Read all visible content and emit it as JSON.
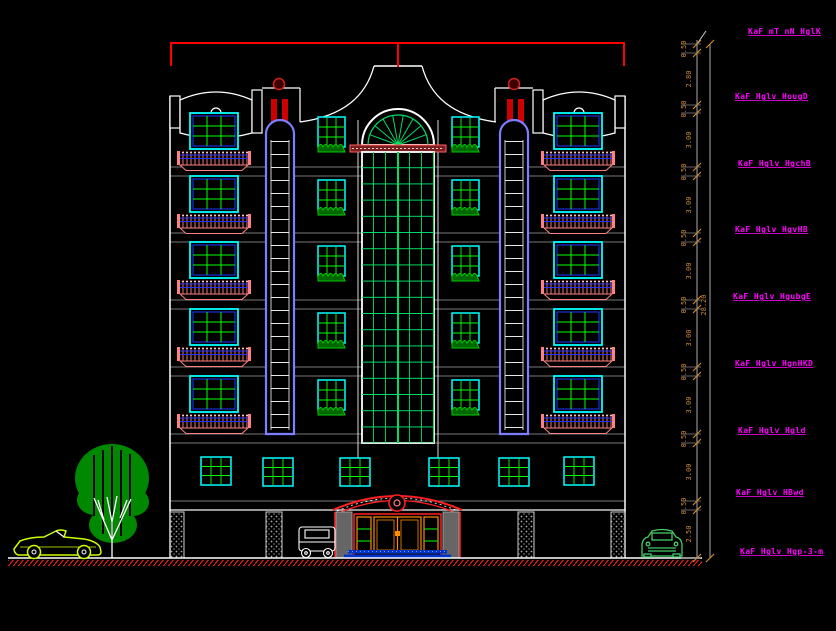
{
  "drawing": {
    "type": "architectural-elevation",
    "background": "#000000",
    "colors": {
      "outline": "#ffffff",
      "red": "#ff0000",
      "window_cyan": "#00ffff",
      "grid_green": "#00ff00",
      "curtain_green": "#00dd66",
      "strip_violet": "#7d7dff",
      "railing_salmon": "#ff8080",
      "railing_blue": "#2233ff",
      "dim_text_orange": "#cc8833",
      "label_magenta": "#ff00ff",
      "ground_hatch_red": "#ff2222",
      "tree_green": "#008800",
      "car_left_yellowgreen": "#ccff00",
      "car_right_green": "#44cc66",
      "door_orange": "#ff8c00"
    },
    "levels": [
      {
        "label": "KaF mT nN HglK"
      },
      {
        "label": "KaF Hglv HougD"
      },
      {
        "label": "KaF Hglv HgchB"
      },
      {
        "label": "KaF Hglv HgvHB"
      },
      {
        "label": "KaF Hglv HgubgE"
      },
      {
        "label": "KaF Hglv HgnHKD"
      },
      {
        "label": "KaF Hglv Hgld"
      },
      {
        "label": "KaF Hglv HBwd"
      },
      {
        "label": "KaF Hglv Hgp-3-m"
      }
    ],
    "dimensions": {
      "overall": "28.20",
      "segments": [
        "0.50",
        "2.80",
        "0.50",
        "3.00",
        "0.50",
        "3.00",
        "0.50",
        "3.00",
        "0.50",
        "3.00",
        "0.50",
        "3.00",
        "0.50",
        "3.00",
        "0.50",
        "2.50"
      ]
    }
  }
}
